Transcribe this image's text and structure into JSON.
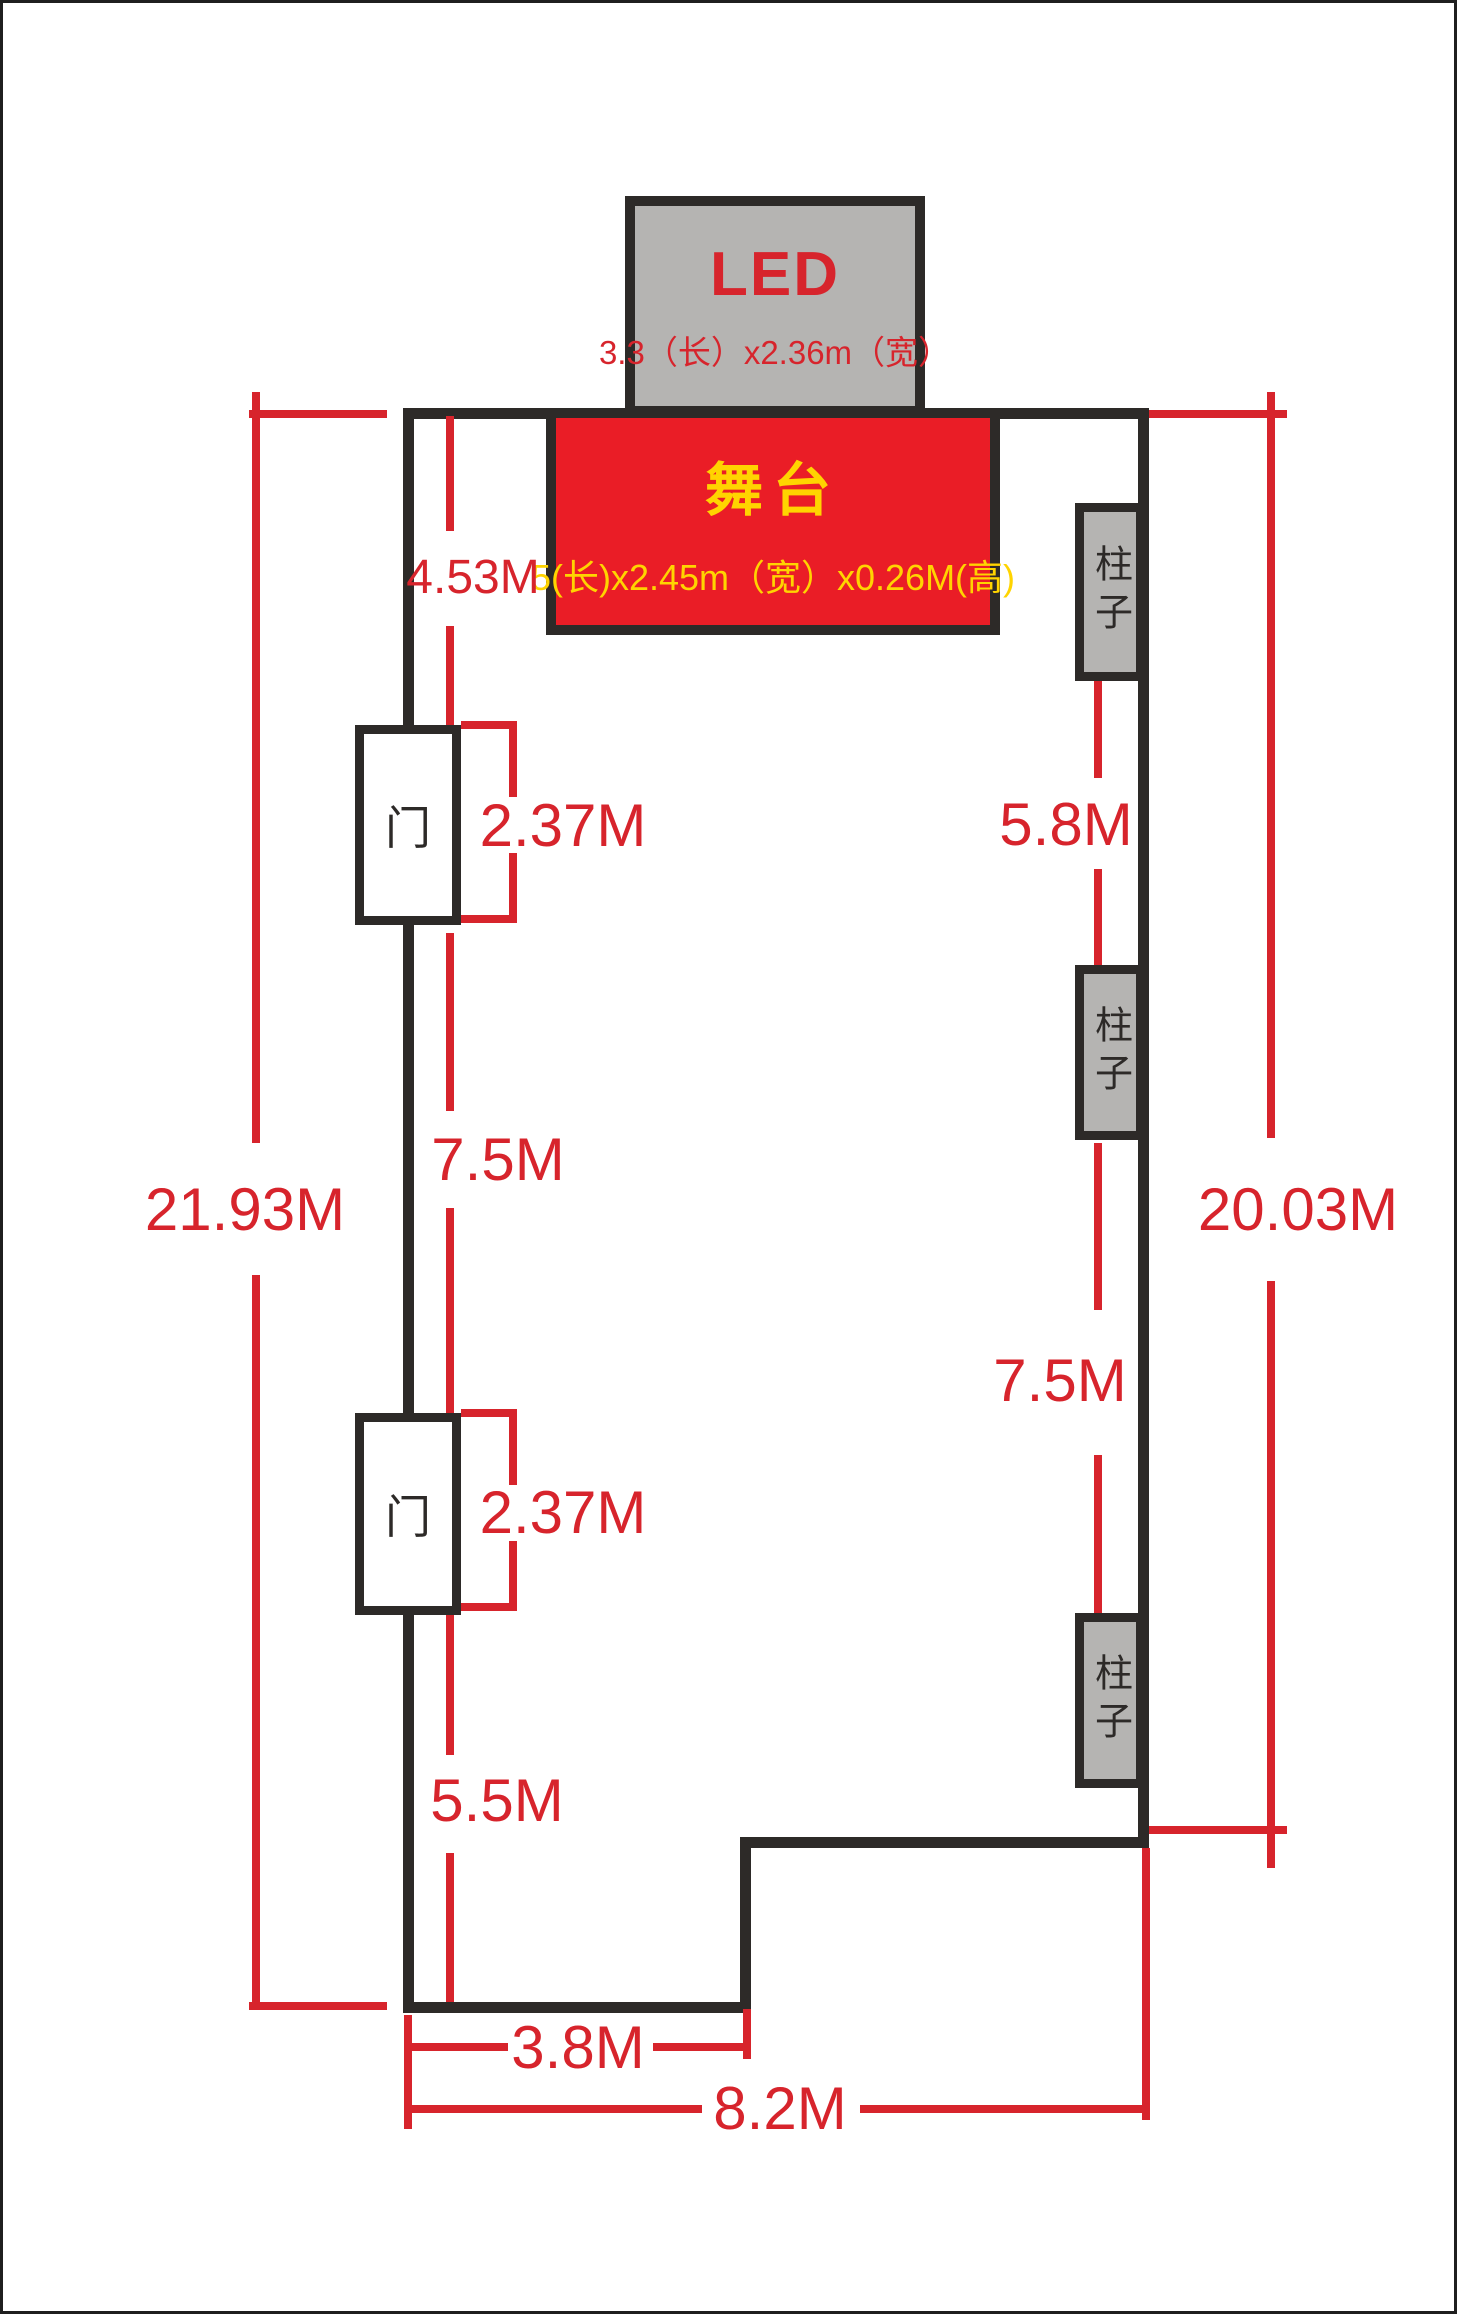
{
  "colors": {
    "wall": "#2d2a28",
    "dimension_red": "#d7242c",
    "stage_red": "#ea1d26",
    "text_yellow": "#ffd400",
    "fill_gray": "#b5b4b2"
  },
  "led": {
    "title": "LED",
    "size": "3.3（长）x2.36m（宽）"
  },
  "stage": {
    "title": "舞台",
    "size": "5(长)x2.45m（宽）x0.26M(高)"
  },
  "doors": [
    {
      "label": "门"
    },
    {
      "label": "门"
    }
  ],
  "columns": [
    {
      "label": "柱子"
    },
    {
      "label": "柱子"
    },
    {
      "label": "柱子"
    }
  ],
  "dims": {
    "left_total": "21.93M",
    "right_total": "20.03M",
    "wall_to_door1": "4.53M",
    "door1_width": "2.37M",
    "door1_to_door2": "7.5M",
    "col1_to_col2": "5.8M",
    "col2_to_col3": "7.5M",
    "door2_width": "2.37M",
    "door2_to_bottom": "5.5M",
    "bottom_left_width": "3.8M",
    "bottom_total_width": "8.2M"
  }
}
